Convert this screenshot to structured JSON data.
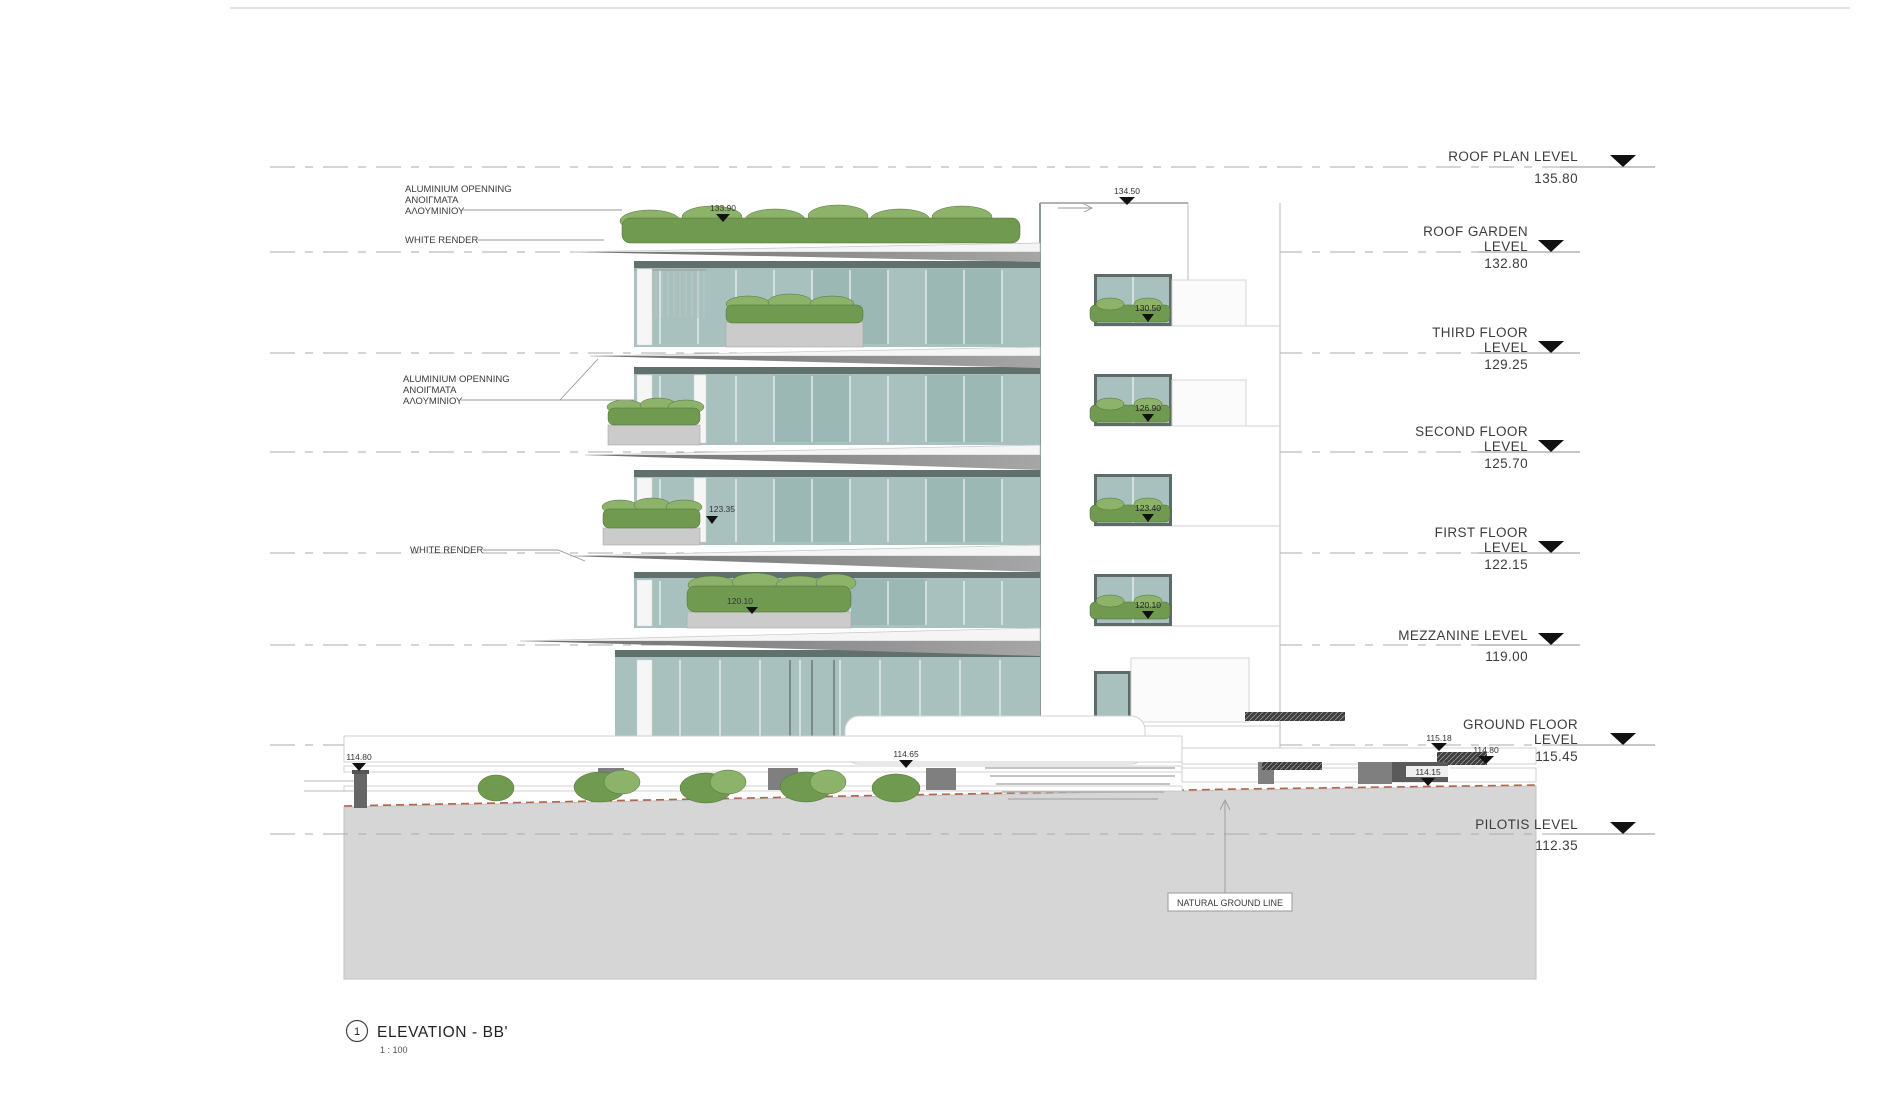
{
  "title_block": {
    "detail_number": "1",
    "title": "ELEVATION - BB'",
    "scale": "1 : 100"
  },
  "levels": [
    {
      "line1": "ROOF PLAN LEVEL",
      "line2": "",
      "value": "135.80"
    },
    {
      "line1": "ROOF GARDEN",
      "line2": "LEVEL",
      "value": "132.80"
    },
    {
      "line1": "THIRD FLOOR",
      "line2": "LEVEL",
      "value": "129.25"
    },
    {
      "line1": "SECOND FLOOR",
      "line2": "LEVEL",
      "value": "125.70"
    },
    {
      "line1": "FIRST FLOOR",
      "line2": "LEVEL",
      "value": "122.15"
    },
    {
      "line1": "MEZZANINE LEVEL",
      "line2": "",
      "value": "119.00"
    },
    {
      "line1": "GROUND FLOOR",
      "line2": "LEVEL",
      "value": "115.45"
    },
    {
      "line1": "PILOTIS LEVEL",
      "line2": "",
      "value": "112.35"
    }
  ],
  "annotations": {
    "aluminium_top": {
      "lines": [
        "ALUMINIUM OPENNING",
        "ΑΝΟΙΓΜΑΤΑ",
        "ΑΛΟΥΜΙΝΙΟΥ"
      ]
    },
    "white_render_top": {
      "label": "WHITE RENDER"
    },
    "aluminium_mid": {
      "lines": [
        "ALUMINIUM OPENNING",
        "ΑΝΟΙΓΜΑΤΑ",
        "ΑΛΟΥΜΙΝΙΟΥ"
      ]
    },
    "white_render_mid": {
      "label": "WHITE RENDER"
    },
    "natural_ground_line": {
      "label": "NATURAL GROUND LINE"
    }
  },
  "spot_elevations": {
    "roof_left": "133.90",
    "roof_right": "134.50",
    "balcony_first": "123.35",
    "balcony_mezzanine": "120.10",
    "wing_third": "130.50",
    "wing_second": "126.90",
    "wing_first": "123.40",
    "wing_mezzanine": "120.10",
    "site_left": "114.80",
    "terrace": "114.65",
    "entry_upper": "115.18",
    "entry_right": "114.80",
    "driveway": "114.15"
  },
  "colors": {
    "glass": "#a9c1be",
    "glass_dark": "#8fb0ad",
    "vegetation": "#6f9a4f",
    "vegetation_light": "#8db26a",
    "ground": "#d6d6d6",
    "natural_ground": "#b2634d",
    "marker": "#111111"
  }
}
